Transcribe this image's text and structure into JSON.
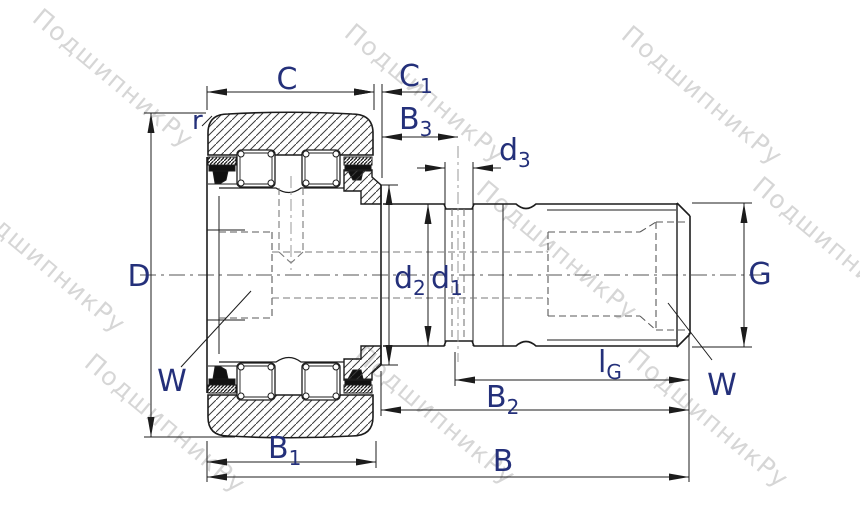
{
  "drawing": {
    "labels": {
      "C": {
        "main": "C",
        "sub": ""
      },
      "C1": {
        "main": "C",
        "sub": "1"
      },
      "B3": {
        "main": "B",
        "sub": "3"
      },
      "d3": {
        "main": "d",
        "sub": "3"
      },
      "r": {
        "main": "r",
        "sub": ""
      },
      "D": {
        "main": "D",
        "sub": ""
      },
      "d2": {
        "main": "d",
        "sub": "2"
      },
      "d1": {
        "main": "d",
        "sub": "1"
      },
      "G": {
        "main": "G",
        "sub": ""
      },
      "W_left": {
        "main": "W",
        "sub": ""
      },
      "W_right": {
        "main": "W",
        "sub": ""
      },
      "lG": {
        "main": "l",
        "sub": "G"
      },
      "B2": {
        "main": "B",
        "sub": "2"
      },
      "B1": {
        "main": "B",
        "sub": "1"
      },
      "B": {
        "main": "B",
        "sub": ""
      }
    },
    "watermark": {
      "text": "ПодшипникРу",
      "color": "#cfcfcf"
    },
    "colors": {
      "line": "#1c1c1c",
      "label": "#24307a",
      "hidden": "#777777",
      "centerline": "#999999",
      "background": "#ffffff"
    }
  }
}
